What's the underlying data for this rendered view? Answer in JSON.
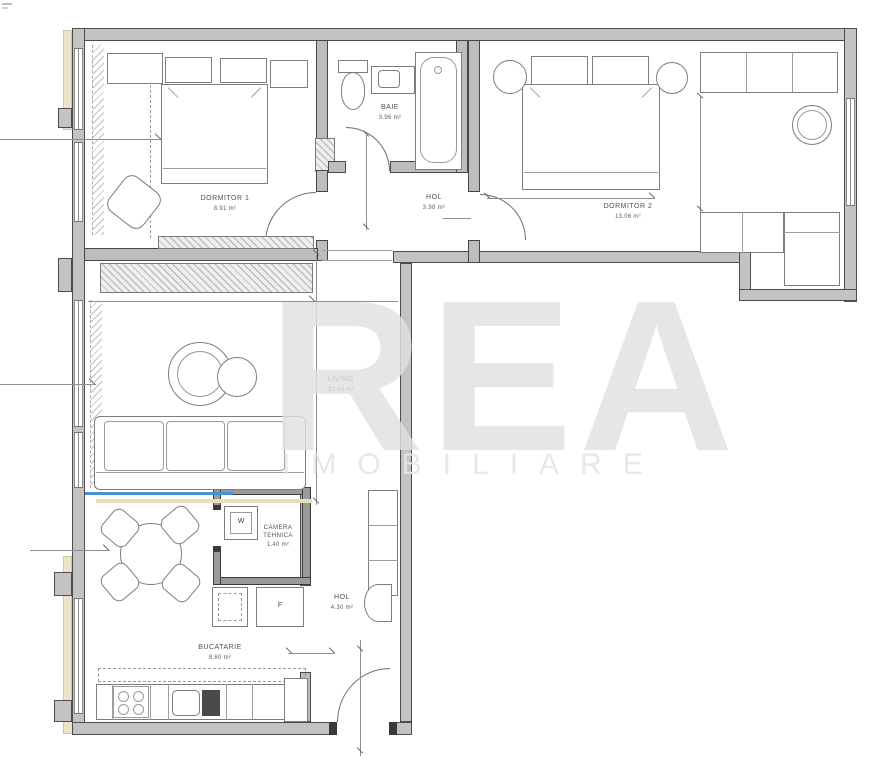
{
  "watermark": {
    "line1": "REA",
    "line2": "IMOBILIARE"
  },
  "rooms": [
    {
      "name": "DORMITOR 1",
      "area": "8.91 m²"
    },
    {
      "name": "BAIE",
      "area": "3.96 m²"
    },
    {
      "name": "HOL",
      "area": "3.98 m²"
    },
    {
      "name": "DORMITOR 2",
      "area": "13.06 m²"
    },
    {
      "name": "LIVING",
      "area": "31.60 m²"
    },
    {
      "name": "CAMERA TEHNICA",
      "area": "1.40 m²"
    },
    {
      "name": "BUCATARIE",
      "area": "8.60 m²"
    },
    {
      "name": "HOL",
      "area": "4.30 m²"
    }
  ],
  "appliances": {
    "washing_machine": "W",
    "fridge": "F"
  },
  "colors": {
    "wall_fill": "#c3c3c3",
    "wall_line": "#4c4c4c",
    "furniture_line": "#7d7d7d",
    "accent_blue": "#4b8fd4",
    "exterior_trim_cream": "#eae4c8",
    "watermark_gray": "#e0e0e0"
  }
}
